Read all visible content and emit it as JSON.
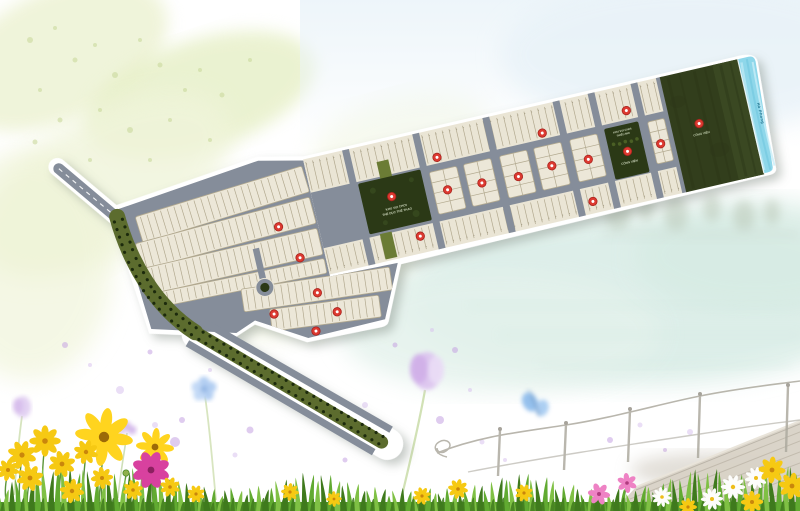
{
  "plan": {
    "rotation_deg": -13,
    "pivot_x": 753,
    "pivot_y": 68,
    "colors": {
      "road": "#858d9a",
      "plot": "#ece7d8",
      "band_base": "#eae5d5",
      "plot_line": "#b2a98f",
      "tick": "#8f8871",
      "park_green": "#2b3916",
      "forest_green": "#323e1c",
      "forest_green2": "#3a4822",
      "olive": "#5c6c2e",
      "olive_median": "#6b7c35",
      "tree_dot": "#1c2a0c",
      "water": "#8ed7ea",
      "marker_red": "#dd3a31",
      "marker_ring": "#a8231d",
      "outline_white": "#ffffff",
      "label_light": "#c9d3b8",
      "water_label": "#1a6d89"
    },
    "labels": {
      "central_park_line1": "KHU VUI CHƠI",
      "central_park_line2": "THỂ DỤC THỂ THAO",
      "playground_line1": "KHU VUI CHƠI",
      "playground_line2": "THIẾU NHI",
      "playground_name": "CÔNG VIÊN",
      "green_park_name": "CÔNG VIÊN",
      "river_name": "Hà Phong"
    },
    "markers": [
      [
        255,
        116
      ],
      [
        269,
        151
      ],
      [
        278,
        189
      ],
      [
        231,
        200
      ],
      [
        293,
        212
      ],
      [
        268,
        226
      ],
      [
        425,
        84
      ],
      [
        533,
        84
      ],
      [
        620,
        81
      ],
      [
        428,
        118
      ],
      [
        463,
        119
      ],
      [
        500,
        121
      ],
      [
        535,
        118
      ],
      [
        572,
        120
      ],
      [
        646,
        121
      ],
      [
        612,
        121
      ],
      [
        372,
        112
      ],
      [
        688,
        110
      ],
      [
        391,
        157
      ],
      [
        567,
        162
      ]
    ],
    "vroads": [
      334,
      406,
      478,
      550,
      586,
      630,
      656
    ],
    "blocks": [
      414,
      449,
      486,
      521,
      558
    ],
    "block_w": 28,
    "small_block": {
      "x": 638,
      "w": 17
    },
    "band": {
      "x0": 294,
      "x1": 658,
      "top_y0": 58,
      "top_y1": 88,
      "bot_y0": 149,
      "bot_y1": 171,
      "pitch": 7
    },
    "fan_strips": [
      [
        118,
        62,
        174,
        27,
        -4,
        291,
        75
      ],
      [
        112,
        94,
        180,
        27,
        -2,
        291,
        107
      ],
      [
        110,
        126,
        182,
        27,
        0,
        0,
        0
      ],
      [
        126,
        157,
        166,
        15,
        1.5,
        292,
        164
      ],
      [
        203,
        180,
        150,
        23,
        4.5,
        352,
        191
      ],
      [
        226,
        205,
        110,
        22,
        5.5,
        336,
        216
      ]
    ],
    "olive_medians": [
      [
        365,
        75,
        12,
        30
      ],
      [
        352,
        146,
        12,
        26
      ]
    ],
    "boulevard_pts": [
      [
        100,
        70
      ],
      [
        104,
        112
      ],
      [
        114,
        150
      ],
      [
        130,
        178
      ],
      [
        152,
        202
      ],
      [
        310,
        350
      ]
    ],
    "roundabout": {
      "x": 228,
      "y": 172
    }
  },
  "decor": {
    "colors": {
      "grass1": "#61aa31",
      "grass2": "#7fc044",
      "grass3": "#3f7a1d",
      "grass_base": "#4e9226",
      "stem": "#4a8a26",
      "cosmos_yellow": "#ffd41f",
      "daisy_yellow": "#f6c913",
      "daisy_center": "#c9860c",
      "cosmos_center": "#9c6a08",
      "magenta": "#d8419f",
      "magenta_center": "#8c2060",
      "white_petal": "#fdfdfb",
      "white_center": "#eebd19",
      "pink": "#ee82c4",
      "pink_center": "#b03a7e",
      "bud": "#8fb04c",
      "speckle": "#c9d89c",
      "dot_lilac": "#d8c2ee",
      "dot_deep": "#c5a2e2"
    },
    "grass_tufts": [
      [
        55,
        26
      ],
      [
        140,
        20
      ],
      [
        310,
        16
      ],
      [
        520,
        15
      ],
      [
        700,
        20
      ],
      [
        785,
        22
      ]
    ],
    "flowers": [
      {
        "t": "cy",
        "x": 104,
        "y": 437,
        "s": 26,
        "stem": 70
      },
      {
        "t": "cy",
        "x": 155,
        "y": 447,
        "s": 17,
        "stem": 55
      },
      {
        "t": "cm",
        "x": 151,
        "y": 470,
        "s": 17,
        "stem": 40
      },
      {
        "t": "dy",
        "x": 22,
        "y": 455,
        "s": 13,
        "stem": 50
      },
      {
        "t": "dy",
        "x": 45,
        "y": 441,
        "s": 14,
        "stem": 60
      },
      {
        "t": "dy",
        "x": 30,
        "y": 478,
        "s": 12,
        "stem": 30
      },
      {
        "t": "dy",
        "x": 62,
        "y": 464,
        "s": 12,
        "stem": 40
      },
      {
        "t": "dy",
        "x": 86,
        "y": 452,
        "s": 11,
        "stem": 55
      },
      {
        "t": "dy",
        "x": 8,
        "y": 470,
        "s": 10,
        "stem": 30
      },
      {
        "t": "dy",
        "x": 72,
        "y": 491,
        "s": 11,
        "stem": 20
      },
      {
        "t": "dy",
        "x": 102,
        "y": 478,
        "s": 10,
        "stem": 25
      },
      {
        "t": "dy",
        "x": 133,
        "y": 490,
        "s": 9,
        "stem": 18
      },
      {
        "t": "dy",
        "x": 170,
        "y": 487,
        "s": 9,
        "stem": 16
      },
      {
        "t": "dy",
        "x": 196,
        "y": 494,
        "s": 8,
        "stem": 12
      },
      {
        "t": "bud",
        "x": 126,
        "y": 473,
        "s": 7,
        "stem": 38
      },
      {
        "t": "dy",
        "x": 290,
        "y": 492,
        "s": 8,
        "stem": 14
      },
      {
        "t": "dy",
        "x": 334,
        "y": 499,
        "s": 7,
        "stem": 10
      },
      {
        "t": "dy",
        "x": 422,
        "y": 496,
        "s": 8,
        "stem": 12
      },
      {
        "t": "dy",
        "x": 458,
        "y": 489,
        "s": 9,
        "stem": 16
      },
      {
        "t": "dy",
        "x": 524,
        "y": 493,
        "s": 8,
        "stem": 12
      },
      {
        "t": "ps",
        "x": 599,
        "y": 494,
        "s": 10,
        "stem": 18
      },
      {
        "t": "ps",
        "x": 627,
        "y": 483,
        "s": 9,
        "stem": 22
      },
      {
        "t": "dw",
        "x": 662,
        "y": 497,
        "s": 9,
        "stem": 10
      },
      {
        "t": "dw",
        "x": 712,
        "y": 499,
        "s": 10,
        "stem": 12
      },
      {
        "t": "dw",
        "x": 733,
        "y": 487,
        "s": 11,
        "stem": 16
      },
      {
        "t": "dw",
        "x": 756,
        "y": 478,
        "s": 10,
        "stem": 20
      },
      {
        "t": "dy",
        "x": 772,
        "y": 470,
        "s": 12,
        "stem": 26
      },
      {
        "t": "dy",
        "x": 792,
        "y": 486,
        "s": 12,
        "stem": 18
      },
      {
        "t": "dy",
        "x": 752,
        "y": 502,
        "s": 10,
        "stem": 8
      },
      {
        "t": "dy",
        "x": 688,
        "y": 507,
        "s": 8,
        "stem": 6
      }
    ],
    "speckles": [
      [
        30,
        40,
        3
      ],
      [
        55,
        28,
        2
      ],
      [
        75,
        60,
        2.5
      ],
      [
        40,
        90,
        2
      ],
      [
        95,
        45,
        2
      ],
      [
        115,
        75,
        3
      ],
      [
        140,
        40,
        2
      ],
      [
        160,
        65,
        2.5
      ],
      [
        185,
        90,
        2
      ],
      [
        60,
        120,
        2.5
      ],
      [
        100,
        110,
        2
      ],
      [
        130,
        130,
        3
      ],
      [
        170,
        120,
        2
      ],
      [
        200,
        70,
        2
      ],
      [
        222,
        95,
        2.5
      ],
      [
        90,
        160,
        2
      ],
      [
        35,
        142,
        2.5
      ],
      [
        150,
        160,
        2
      ],
      [
        210,
        140,
        2
      ],
      [
        250,
        60,
        2
      ]
    ],
    "pastel_dots": [
      [
        65,
        345,
        3
      ],
      [
        90,
        365,
        2
      ],
      [
        150,
        352,
        2.5
      ],
      [
        120,
        390,
        4
      ],
      [
        182,
        420,
        3
      ],
      [
        210,
        370,
        2
      ],
      [
        250,
        430,
        3.5
      ],
      [
        235,
        455,
        2.5
      ],
      [
        310,
        415,
        2
      ],
      [
        365,
        405,
        3
      ],
      [
        395,
        345,
        2.5
      ],
      [
        432,
        330,
        2
      ],
      [
        455,
        350,
        3
      ],
      [
        470,
        390,
        2
      ],
      [
        440,
        420,
        4
      ],
      [
        482,
        442,
        2.5
      ],
      [
        610,
        440,
        3
      ],
      [
        640,
        425,
        2.5
      ],
      [
        665,
        450,
        2
      ],
      [
        690,
        432,
        3
      ],
      [
        175,
        442,
        5
      ],
      [
        155,
        425,
        3
      ],
      [
        345,
        460,
        2.5
      ],
      [
        505,
        460,
        2
      ]
    ]
  }
}
